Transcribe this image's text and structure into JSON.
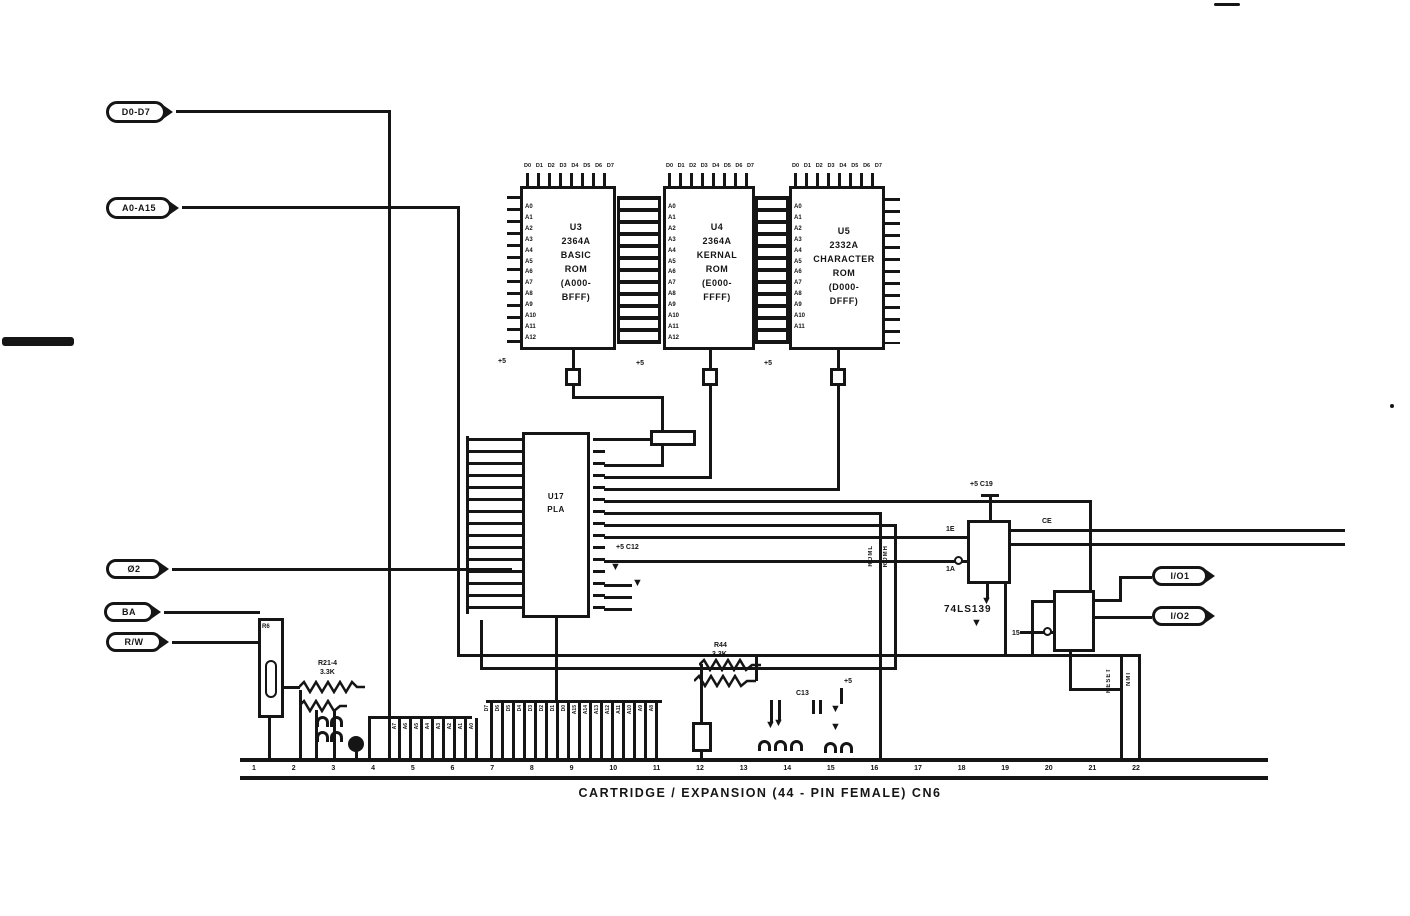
{
  "page": {
    "caption": "CARTRIDGE / EXPANSION  (44 - PIN FEMALE)    CN6"
  },
  "connectors_left": {
    "data_bus": "D0-D7",
    "addr_bus": "A0-A15",
    "phi2": "Ø2",
    "ba": "BA",
    "rw": "R/W"
  },
  "connectors_right": {
    "io1": "I/O1",
    "io2": "I/O2"
  },
  "chips": {
    "u3": {
      "lines": [
        "U3",
        "2364A",
        "BASIC",
        "ROM",
        "(A000-",
        "BFFF)"
      ]
    },
    "u4": {
      "lines": [
        "U4",
        "2364A",
        "KERNAL",
        "ROM",
        "(E000-",
        "FFFF)"
      ]
    },
    "u5": {
      "lines": [
        "U5",
        "2332A",
        "CHARACTER",
        "ROM",
        "(D000-",
        "DFFF)"
      ]
    },
    "u17": {
      "lines": [
        "U17",
        "PLA"
      ]
    },
    "u15": {
      "label": "74LS139"
    }
  },
  "pin_labels": {
    "u3_left": [
      "A0",
      "A1",
      "A2",
      "A3",
      "A4",
      "A5",
      "A6",
      "A7",
      "A8",
      "A9",
      "A10",
      "A11",
      "A12"
    ],
    "u4_left": [
      "A0",
      "A1",
      "A2",
      "A3",
      "A4",
      "A5",
      "A6",
      "A7",
      "A8",
      "A9",
      "A10",
      "A11",
      "A12"
    ],
    "u5_left": [
      "A0",
      "A1",
      "A2",
      "A3",
      "A4",
      "A5",
      "A6",
      "A7",
      "A8",
      "A9",
      "A10",
      "A11"
    ],
    "rom_top": [
      "D0",
      "D1",
      "D2",
      "D3",
      "D4",
      "D5",
      "D6",
      "D7"
    ],
    "cluster_a": [
      "A7",
      "A6",
      "A5",
      "A4",
      "A3",
      "A2",
      "A1",
      "A0"
    ],
    "cluster_b": [
      "D7",
      "D6",
      "D5",
      "D4",
      "D3",
      "D2",
      "D1",
      "D0",
      "A15",
      "A14",
      "A13",
      "A12",
      "A11",
      "A10",
      "A9",
      "A8"
    ]
  },
  "connector_bar": {
    "pins": [
      "1",
      "2",
      "3",
      "4",
      "5",
      "6",
      "7",
      "8",
      "9",
      "10",
      "11",
      "12",
      "13",
      "14",
      "15",
      "16",
      "17",
      "18",
      "19",
      "20",
      "21",
      "22"
    ]
  },
  "labels": {
    "r21": "R21-4",
    "r21_val": "3.3K",
    "r44": "R44",
    "r44_val": "3.3K",
    "r6": "R6",
    "c13": "C13",
    "plus5_c12": "+5 C12",
    "plus5_c19": "+5 C19",
    "plus5_a": "+5",
    "plus5_b": "+5",
    "plus5_c": "+5",
    "plus5_d": "+5",
    "de": "1E",
    "ae": "1A",
    "ce": "CE",
    "p15": "15",
    "roml": "ROML",
    "romh": "ROMH",
    "reset": "RESET",
    "nmi": "NMI"
  }
}
